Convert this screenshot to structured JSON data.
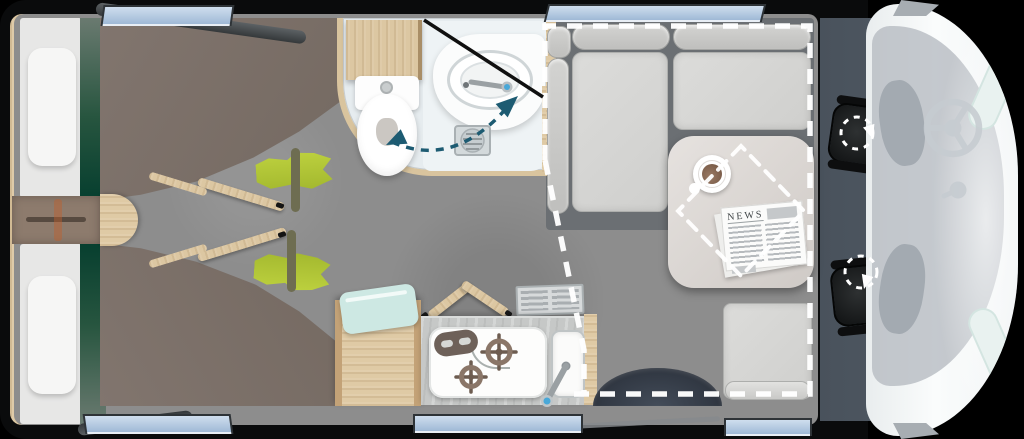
{
  "scene": {
    "title": "Motorhome floor plan (top view)",
    "description": "Camper layout: rear twin beds, bathroom, kitchenette, front dinette with drop-down bed outline, driver cab with swivel seats"
  },
  "lounge": {
    "newspaper_title": "NEWS",
    "features": [
      "l-shaped-sofa",
      "side-bench",
      "dining-table",
      "coffee-cup",
      "newspaper",
      "drop-down-bed-dashed-outline",
      "entry-door"
    ]
  },
  "bedroom": {
    "beds": 2,
    "features": [
      "pillow",
      "mattress",
      "green-runner",
      "duvet",
      "hanging-shirt",
      "ladder-slats",
      "bedside-step",
      "rear-cabinet-decor"
    ]
  },
  "bathroom": {
    "features": [
      "toilet",
      "cistern-flush-button",
      "corner-washbasin",
      "faucet",
      "shower-screen",
      "shower-drain",
      "swivel-space-arrow",
      "overhead-cabinet"
    ]
  },
  "kitchen": {
    "features": [
      "two-burner-hob",
      "hob-control-panel",
      "sink",
      "faucet",
      "vent-grille",
      "worktop",
      "mint-towel",
      "wood-cabinet"
    ]
  },
  "cab": {
    "features": [
      "driver-swivel-seat",
      "passenger-swivel-seat",
      "swivel-arrows",
      "steering-wheel",
      "gear-knob",
      "windshield",
      "headlights",
      "side-mirrors",
      "van-nose"
    ]
  },
  "windows": {
    "count": 6,
    "positions": [
      "top-left",
      "top-right",
      "bottom-left",
      "bottom-middle",
      "bottom-right",
      "open-flaps-left"
    ]
  },
  "colors": {
    "wall_black": "#0a0b0c",
    "floor_gray": "#8d8d8d",
    "duvet_brown": "#7b6f68",
    "bed_accent_green": "#073f2f",
    "shirt_green": "#b7c93a",
    "wood": "#dcc7a2",
    "window_blue": "#aec6e0",
    "bathroom_arrow_teal": "#1d5b72",
    "swivel_arrow": "#ffffff",
    "cab_floor_slate": "#4b545e",
    "seat_black": "#17191a",
    "van_body_white": "#f5f8f9",
    "cushion_gray": "#d8d8d6",
    "table_gray": "#ddd8d4",
    "mint_towel": "#cde8e3",
    "faucet_dot_blue": "#49a8d8"
  }
}
